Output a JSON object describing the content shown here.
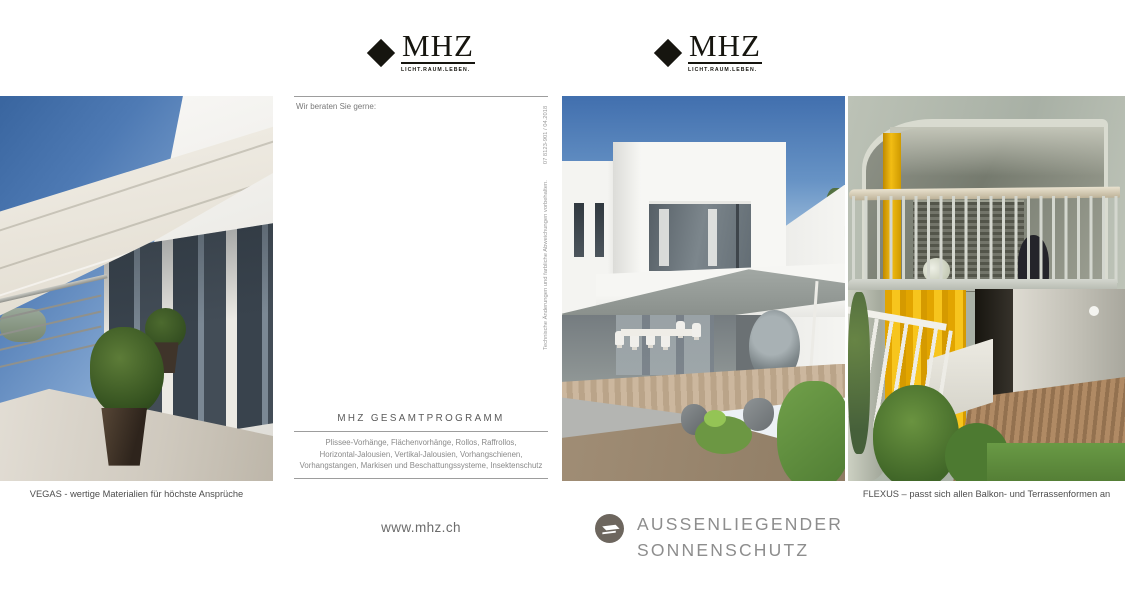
{
  "brand": {
    "name": "MHZ",
    "tagline": "LICHT.RAUM.LEBEN."
  },
  "middle_panel": {
    "greeting": "Wir beraten Sie gerne:",
    "side_note_text": "Technische Änderungen und farbliche Abweichungen vorbehalten.",
    "side_note_code": "07 8123-901 / 04.2018",
    "program": {
      "title": "MHZ GESAMTPROGRAMM",
      "lines": [
        "Plissee-Vorhänge, Flächenvorhänge, Rollos, Raffrollos,",
        "Horizontal-Jalousien, Vertikal-Jalousien, Vorhangschienen,",
        "Vorhangstangen, Markisen und Beschattungssysteme, Insektenschutz"
      ]
    },
    "website": "www.mhz.ch"
  },
  "cover": {
    "title_line1": "AUSSENLIEGENDER",
    "title_line2": "SONNENSCHUTZ",
    "icon": "awning-icon"
  },
  "photos": {
    "left": {
      "caption": "VEGAS - wertige Materialien für höchste Ansprüche"
    },
    "right": {
      "caption": "FLEXUS – passt sich allen Balkon- und Terrassenformen an"
    }
  },
  "colors": {
    "logo_black": "#16150f",
    "cover_icon_bg": "#6d665e",
    "cover_title_gray": "#8d8d8d",
    "flexus_yellow": "#f2bd14"
  }
}
